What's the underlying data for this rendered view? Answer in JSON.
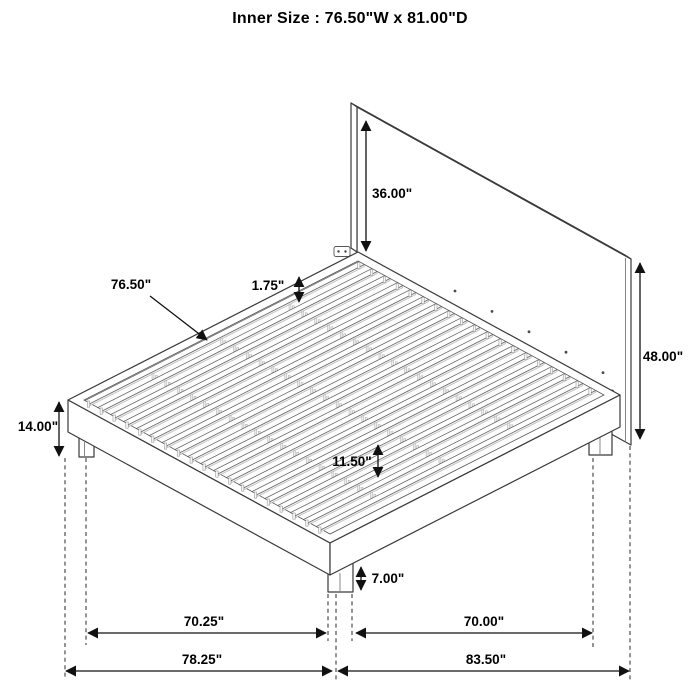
{
  "title": "Inner Size : 76.50\"W x 81.00\"D",
  "units": "inches",
  "dimensions": {
    "headboard_panel_height": "36.00\"",
    "slat_area_width": "76.50\"",
    "slat_thickness": "1.75\"",
    "headboard_total_height": "48.00\"",
    "platform_top_height": "14.00\"",
    "slat_gap_clearance": "11.50\"",
    "leg_height": "7.00\"",
    "leg_spacing_front": "70.25\"",
    "leg_spacing_side": "70.00\"",
    "overall_width": "78.25\"",
    "overall_depth": "83.50\""
  },
  "drawing": {
    "slat_count": 19,
    "line_color": "#3a3a3a",
    "dim_color": "#111111",
    "background": "#ffffff"
  }
}
